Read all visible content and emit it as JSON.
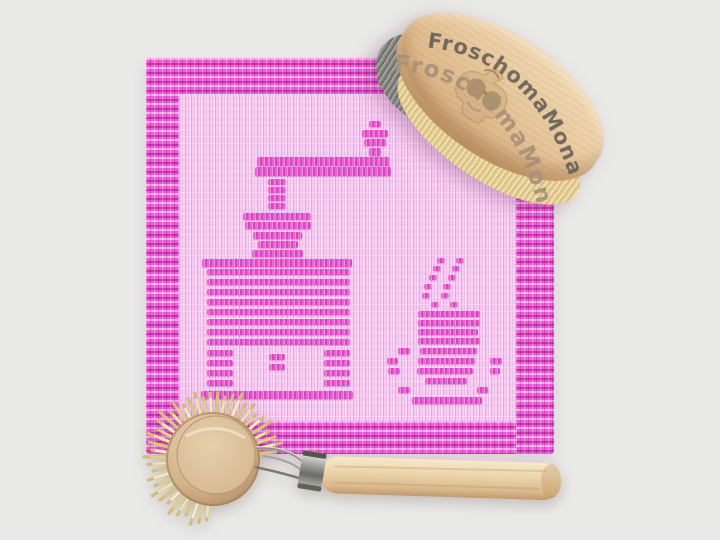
{
  "scene": {
    "background_color": "#e9e9e7",
    "alt": "Pink crocheted dishcloth with a knitted coffee grinder and steaming coffee cup motif, shown with an oval wooden scrub brush stamped FroschomaMona and a round wooden dish brush with a long handle"
  },
  "cloth": {
    "base_color": "#f3c2ec",
    "rib_color": "#e9a7df",
    "border_color": "#e85cd3",
    "border_dark": "#cc2fae",
    "border_light": "#f7b0ec",
    "motif_color": "#e05ecd",
    "motifs": {
      "coffee_grinder": [
        [
          223,
          63,
          12,
          6
        ],
        [
          216,
          72,
          26,
          7
        ],
        [
          218,
          81,
          22,
          7
        ],
        [
          223,
          90,
          12,
          8
        ],
        [
          111,
          99,
          133,
          9
        ],
        [
          109,
          109,
          136,
          9
        ],
        [
          122,
          121,
          18,
          6
        ],
        [
          122,
          129,
          18,
          6
        ],
        [
          122,
          137,
          18,
          6
        ],
        [
          122,
          145,
          18,
          6
        ],
        [
          97,
          155,
          68,
          7
        ],
        [
          99,
          164,
          66,
          7
        ],
        [
          107,
          174,
          49,
          7
        ],
        [
          112,
          183,
          40,
          7
        ],
        [
          106,
          192,
          51,
          7
        ],
        [
          56,
          201,
          150,
          8
        ],
        [
          61,
          211,
          143,
          6
        ],
        [
          61,
          221,
          143,
          6
        ],
        [
          61,
          231,
          143,
          6
        ],
        [
          61,
          241,
          143,
          6
        ],
        [
          61,
          251,
          143,
          6
        ],
        [
          61,
          261,
          143,
          6
        ],
        [
          61,
          271,
          143,
          6
        ],
        [
          61,
          281,
          143,
          6
        ],
        [
          61,
          292,
          26,
          6
        ],
        [
          61,
          302,
          26,
          6
        ],
        [
          61,
          312,
          26,
          6
        ],
        [
          61,
          322,
          26,
          6
        ],
        [
          178,
          292,
          26,
          6
        ],
        [
          178,
          302,
          26,
          6
        ],
        [
          178,
          312,
          26,
          6
        ],
        [
          178,
          322,
          26,
          6
        ],
        [
          123,
          296,
          16,
          6
        ],
        [
          123,
          306,
          16,
          6
        ],
        [
          55,
          333,
          152,
          8
        ]
      ],
      "coffee_cup": [
        [
          272,
          253,
          62,
          6
        ],
        [
          272,
          262,
          62,
          6
        ],
        [
          272,
          271,
          60,
          6
        ],
        [
          272,
          280,
          62,
          6
        ],
        [
          274,
          290,
          57,
          6
        ],
        [
          272,
          300,
          57,
          6
        ],
        [
          271,
          310,
          56,
          6
        ],
        [
          279,
          320,
          42,
          6
        ],
        [
          266,
          339,
          70,
          7
        ],
        [
          252,
          290,
          12,
          6
        ],
        [
          241,
          300,
          11,
          6
        ],
        [
          242,
          310,
          12,
          6
        ],
        [
          252,
          329,
          12,
          6
        ],
        [
          344,
          300,
          12,
          6
        ],
        [
          344,
          310,
          10,
          6
        ],
        [
          331,
          329,
          11,
          6
        ]
      ],
      "steam": [
        [
          291,
          200,
          8,
          5
        ],
        [
          310,
          200,
          8,
          5
        ],
        [
          287,
          208,
          8,
          5
        ],
        [
          306,
          208,
          8,
          5
        ],
        [
          283,
          217,
          8,
          5
        ],
        [
          302,
          217,
          8,
          5
        ],
        [
          278,
          226,
          8,
          5
        ],
        [
          297,
          226,
          8,
          5
        ],
        [
          276,
          235,
          8,
          5
        ],
        [
          295,
          235,
          8,
          5
        ],
        [
          285,
          244,
          8,
          5
        ],
        [
          304,
          244,
          8,
          5
        ]
      ]
    }
  },
  "oval_brush": {
    "brand_text": "FroschomaMona",
    "logo": "frog-with-sunglasses",
    "wood_color": "#e8c89e",
    "engraving_color": "#625d55",
    "engraving_color_2": "#a7917a",
    "bristle_gray": "#8e8c86",
    "bristle_cream": "#ecdca6"
  },
  "dish_brush": {
    "head_wood_color": "#d5b791",
    "bristle_color": "#ecdfa9",
    "ferrule_color": "#b9bab6",
    "handle_color": "#ecd4ac"
  }
}
